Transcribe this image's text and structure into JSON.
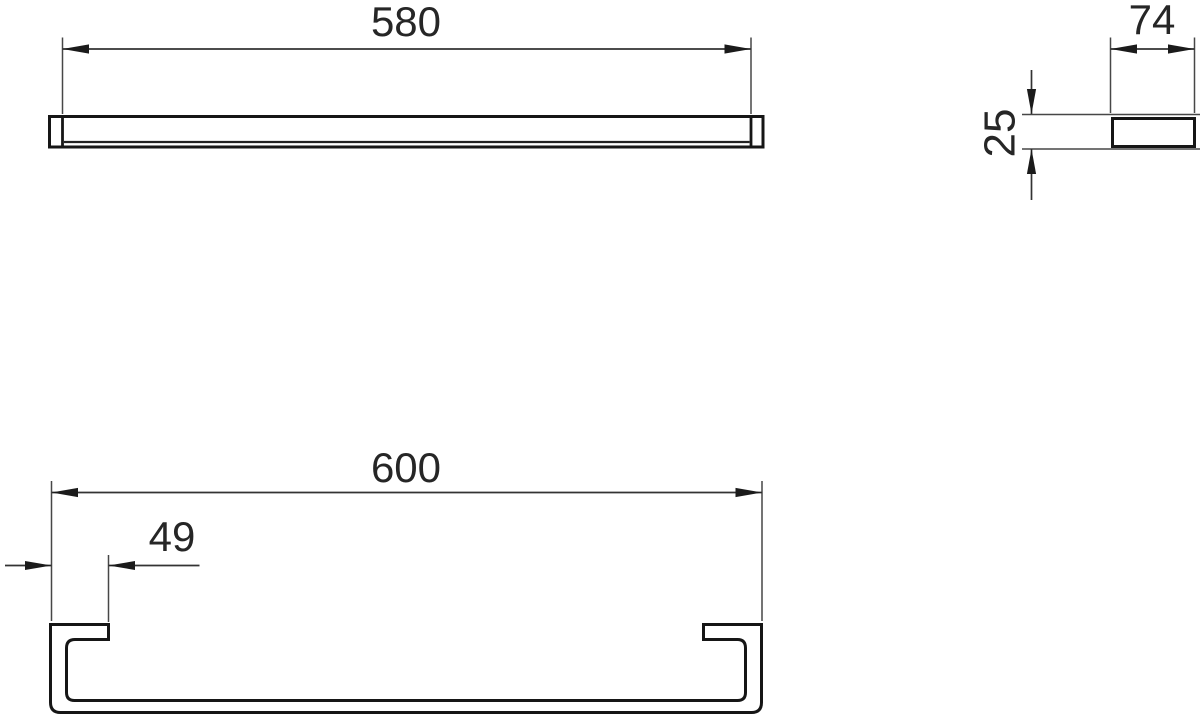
{
  "drawing": {
    "background_color": "#ffffff",
    "line_color": "#1b1b1b",
    "front_view": {
      "length": "580"
    },
    "side_view": {
      "depth": "74",
      "height": "25"
    },
    "plan_view": {
      "overall_length": "600",
      "bracket_plate_width": "49"
    }
  }
}
